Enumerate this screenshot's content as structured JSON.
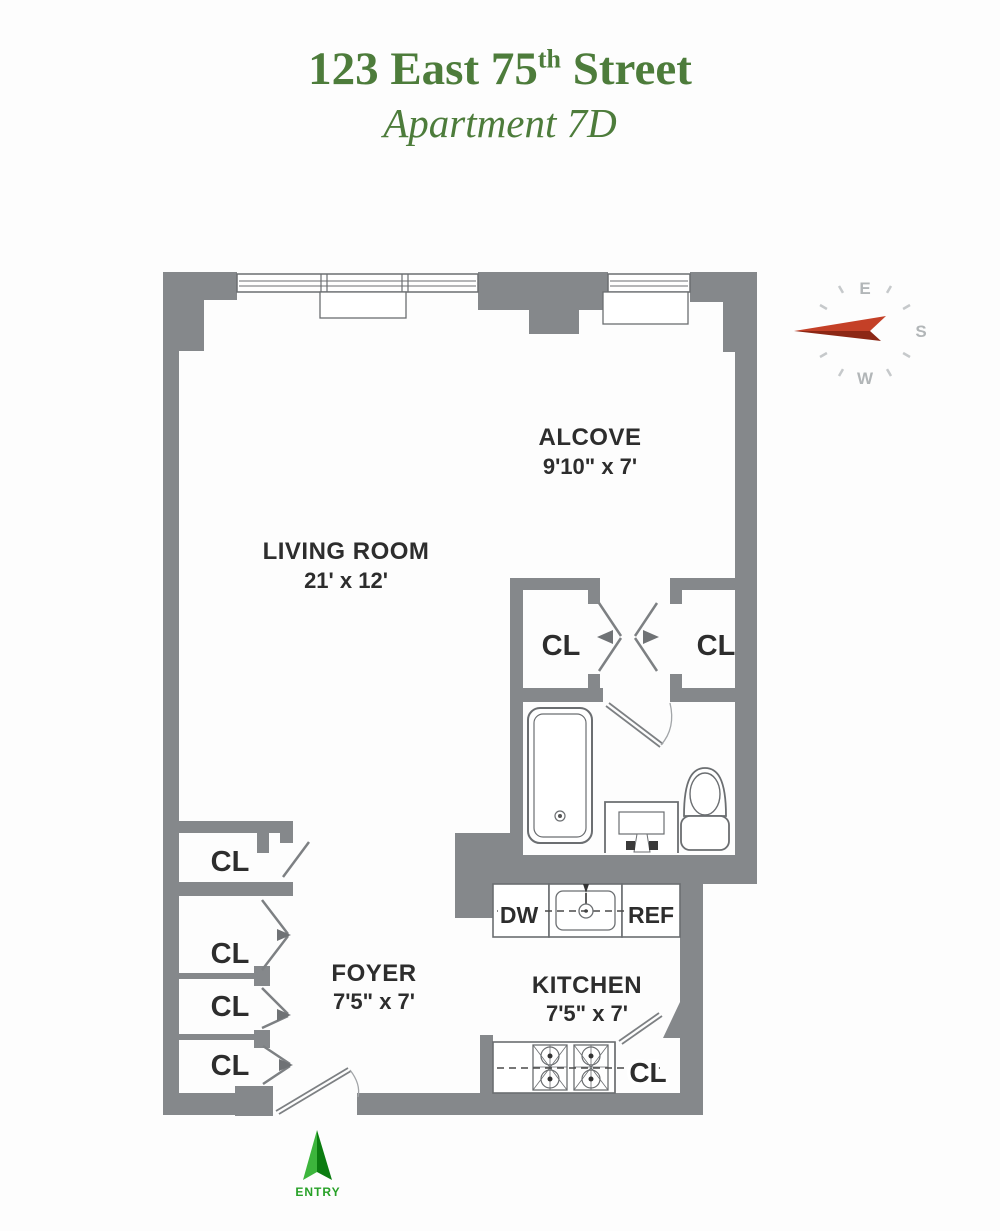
{
  "title": {
    "line1_pre": "123 East 75",
    "line1_sup": "th",
    "line1_post": " Street",
    "line2": "Apartment 7D"
  },
  "colors": {
    "title_green": "#4d7c3b",
    "wall_gray": "#85888b",
    "label_dark": "#2d2d2d",
    "compass_letter_gray": "#b2b6b8",
    "needle_red_top": "#c44027",
    "needle_red_bottom": "#8c2715",
    "entry_green_light": "#3cb53c",
    "entry_green_dark": "#0b7c10"
  },
  "compass": {
    "east": "E",
    "south": "S",
    "west": "W"
  },
  "rooms": {
    "living_room": {
      "name": "LIVING ROOM",
      "dims": "21' x 12'"
    },
    "alcove": {
      "name": "ALCOVE",
      "dims": "9'10\" x 7'"
    },
    "foyer": {
      "name": "FOYER",
      "dims": "7'5\" x 7'"
    },
    "kitchen": {
      "name": "KITCHEN",
      "dims": "7'5\" x 7'"
    }
  },
  "labels": {
    "closet": "CL",
    "dishwasher": "DW",
    "refrigerator": "REF",
    "entry": "ENTRY"
  }
}
